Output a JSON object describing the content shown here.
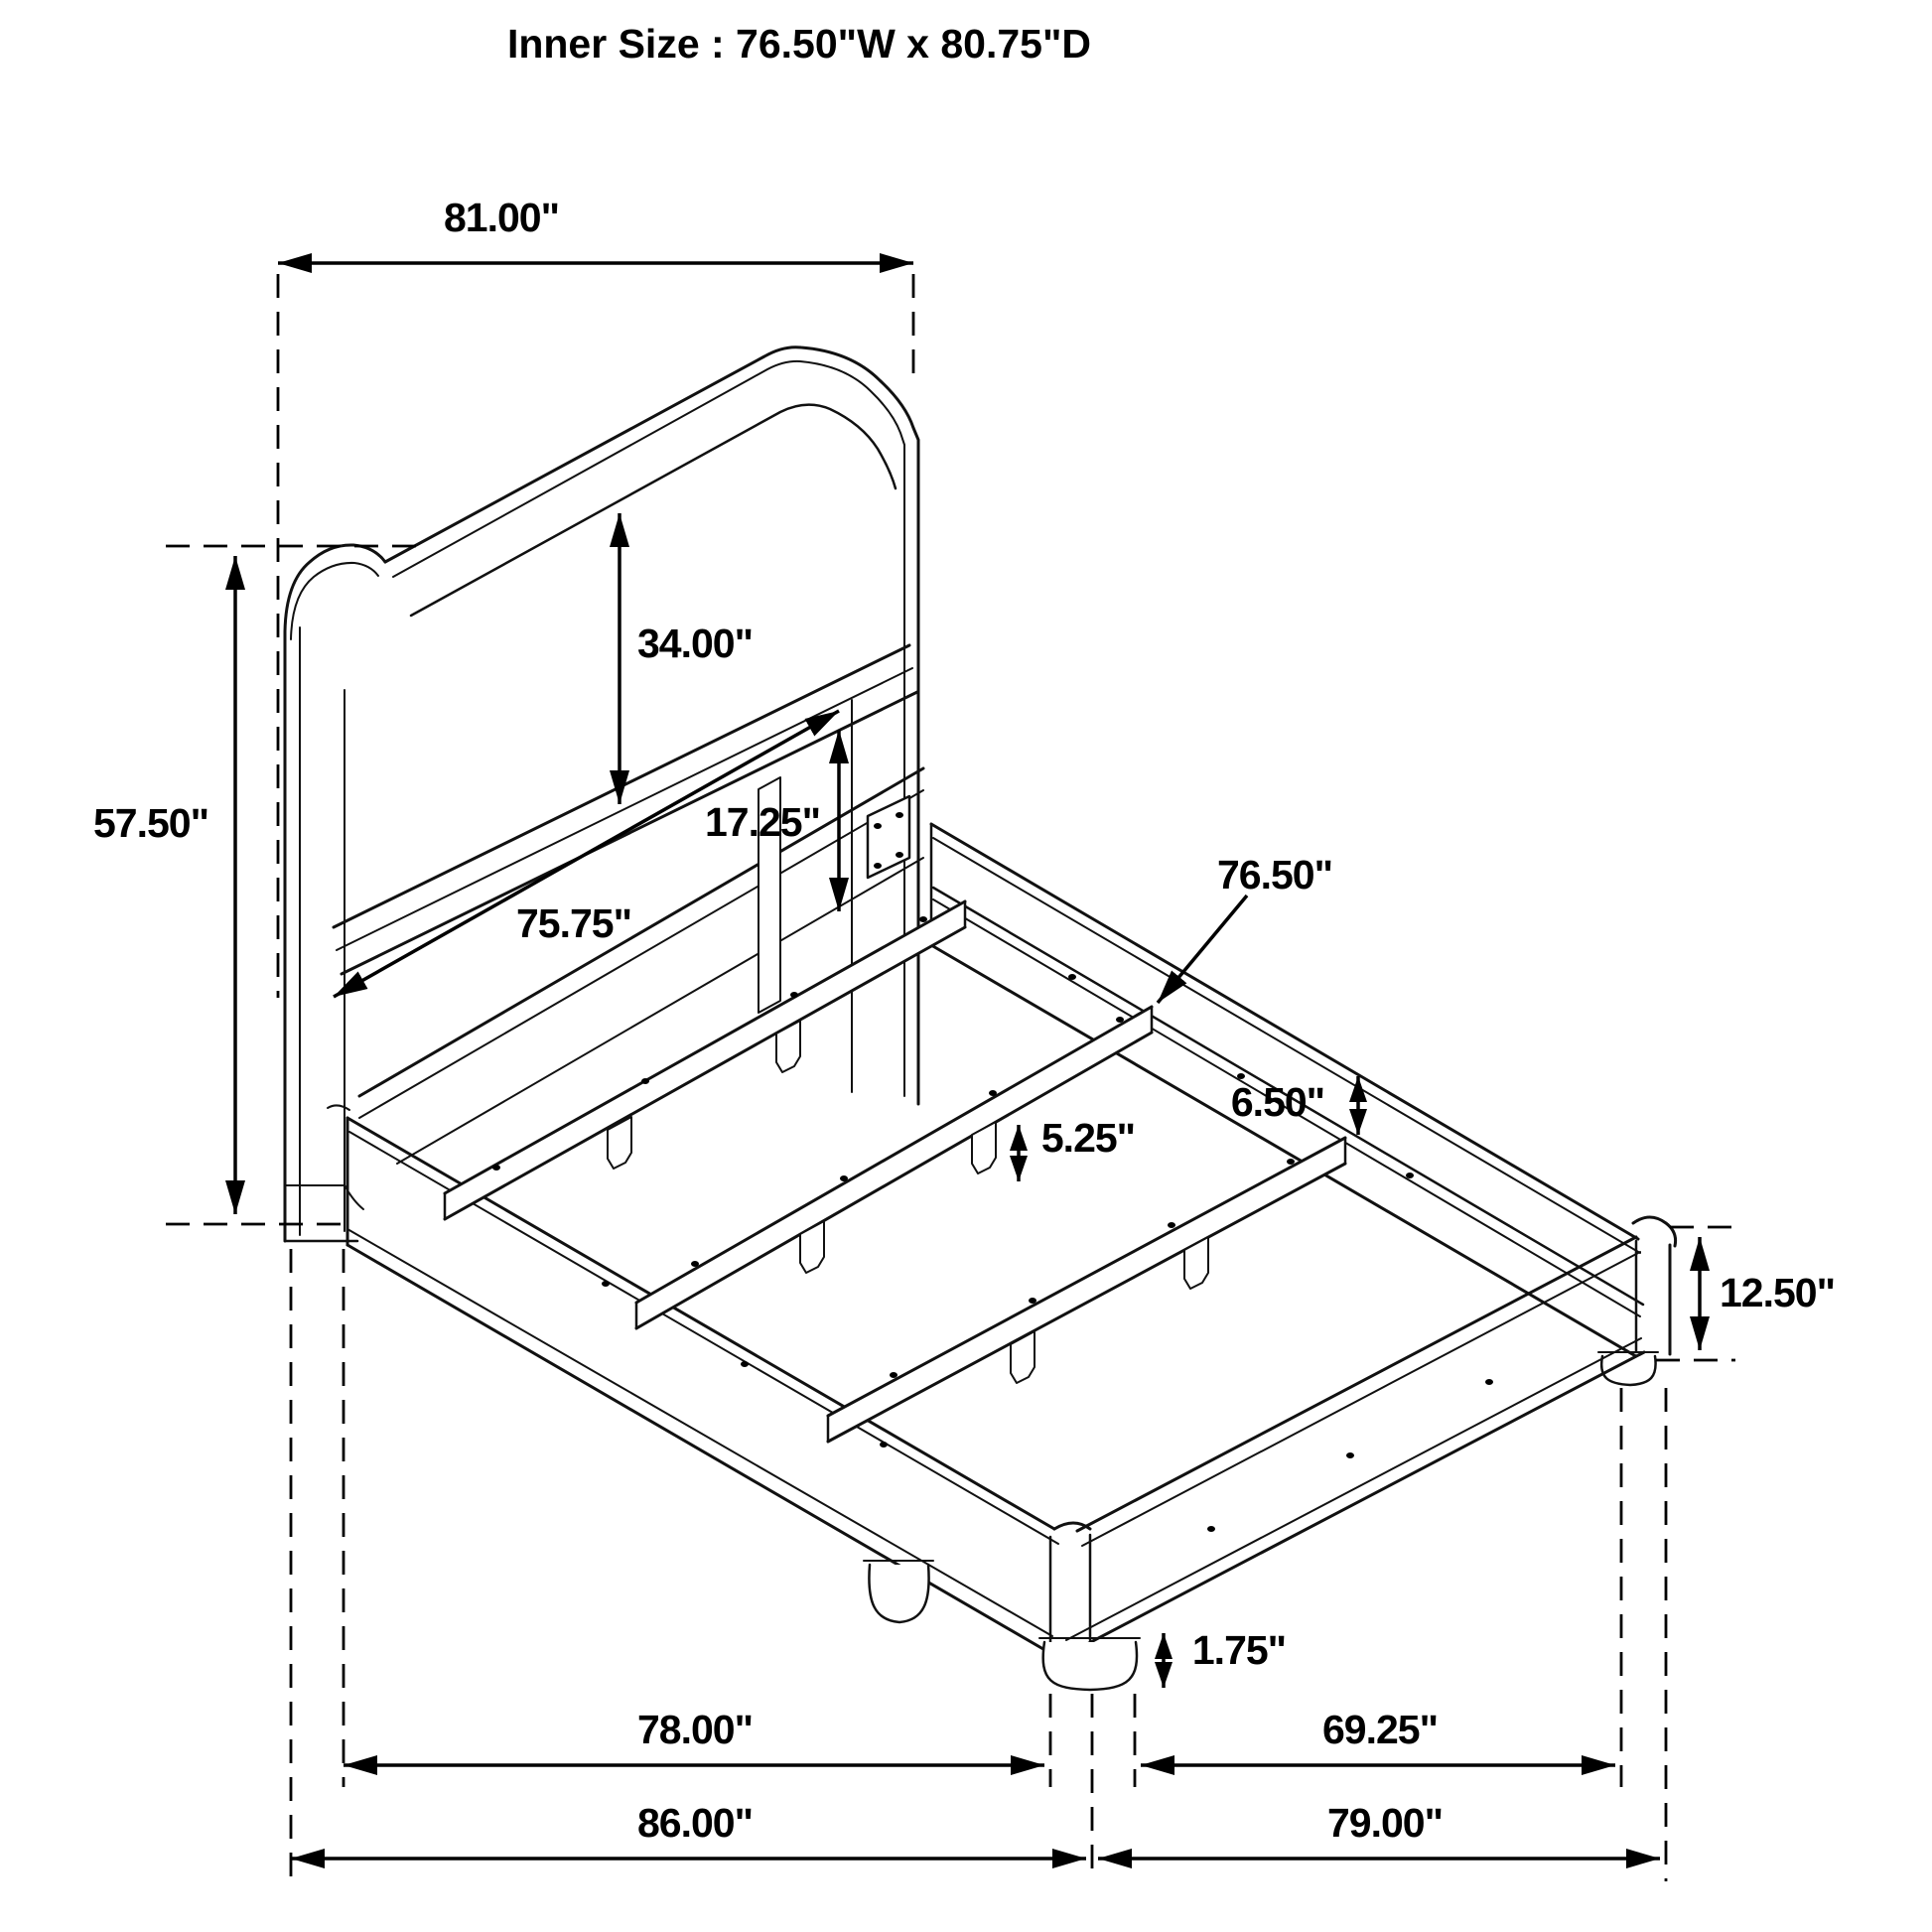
{
  "title": "Inner Size : 76.50\"W x 80.75\"D",
  "dimensions": {
    "headboard_width": "81.00\"",
    "headboard_height": "57.50\"",
    "panel_height": "34.00\"",
    "rail_mount_height": "17.25\"",
    "panel_inner_width": "75.75\"",
    "slat_length": "76.50\"",
    "rail_to_slat": "6.50\"",
    "slat_leg_height": "5.25\"",
    "side_rail_height": "12.50\"",
    "foot_height": "1.75\"",
    "rail_length_inner": "78.00\"",
    "foot_rail_inner": "69.25\"",
    "total_depth": "86.00\"",
    "total_width": "79.00\""
  },
  "colors": {
    "line": "#111111",
    "dimension": "#000000",
    "background": "#ffffff"
  }
}
